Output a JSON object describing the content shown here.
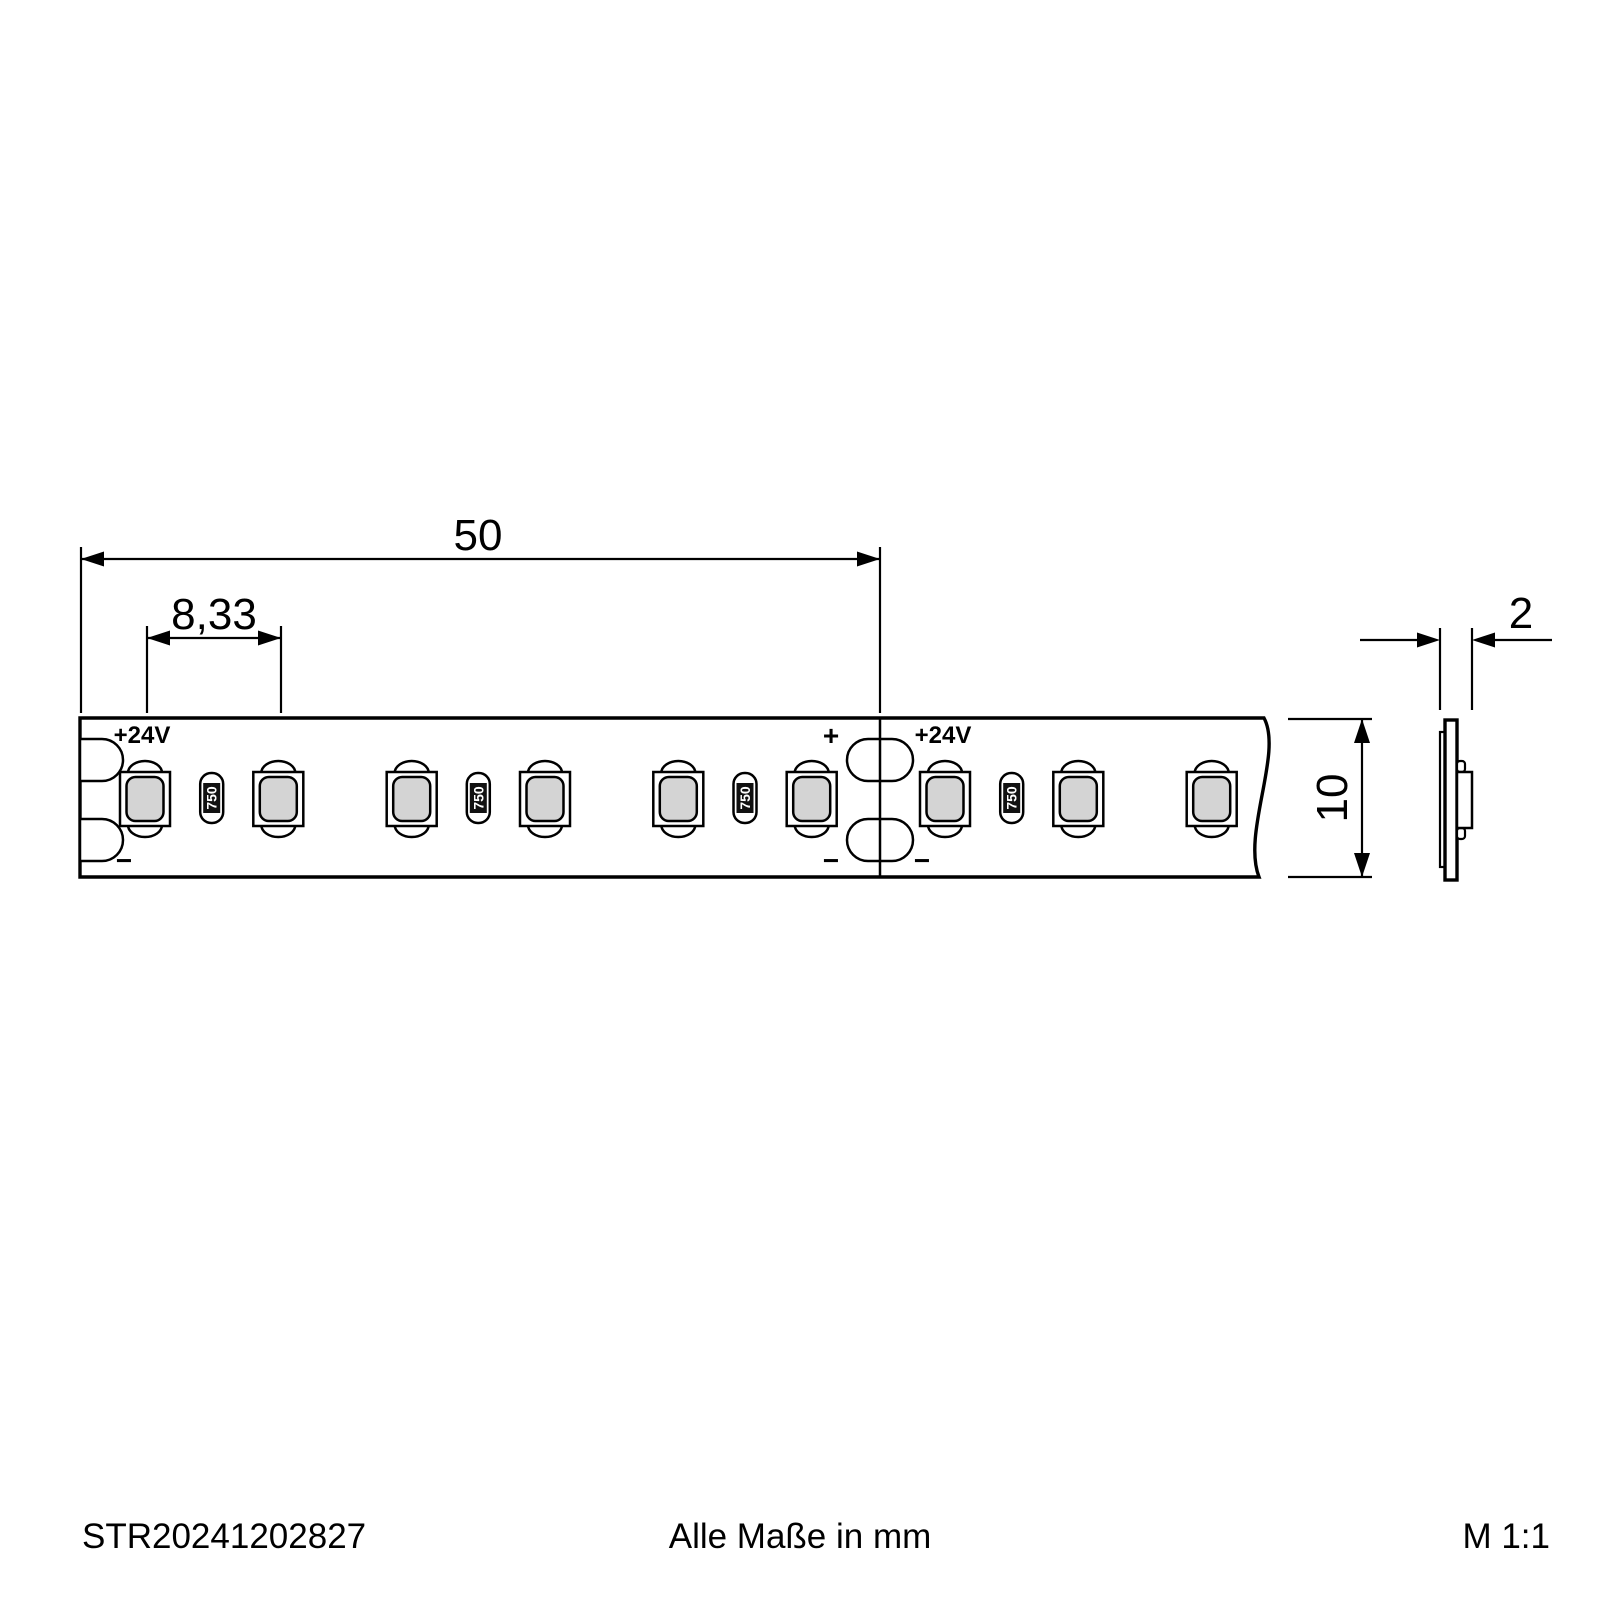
{
  "dimensions": {
    "segment_length": "50",
    "led_pitch": "8,33",
    "strip_width": "10",
    "strip_thickness": "2"
  },
  "strip": {
    "voltage_label": "+24V",
    "plus_label": "+",
    "minus_label": "−",
    "resistor_code": "750",
    "led_count": 9,
    "resistor_count": 4,
    "colors": {
      "background": "#ffffff",
      "line": "#000000",
      "led_fill": "#d4d4d4",
      "resistor_band": "#111111"
    }
  },
  "footer": {
    "article_number": "STR20241202827",
    "units_note": "Alle Maße in mm",
    "scale": "M 1:1"
  }
}
